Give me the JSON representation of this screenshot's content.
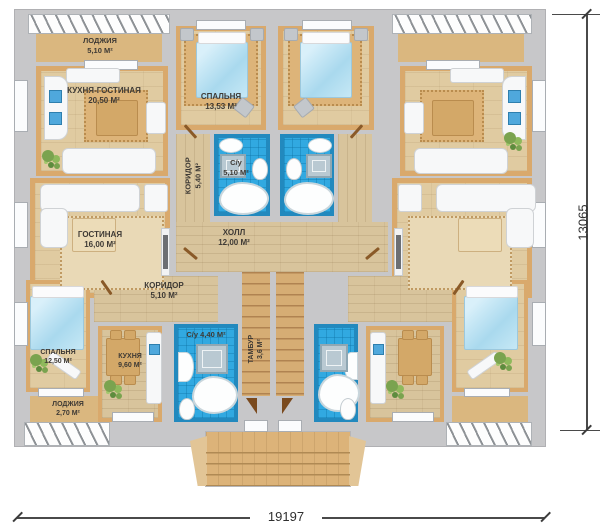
{
  "rooms": {
    "loggia_top_left": {
      "name": "ЛОДЖИЯ",
      "area": "5,10 М²"
    },
    "kitchen_living": {
      "name": "КУХНЯ-ГОСТИНАЯ",
      "area": "20,50 М²"
    },
    "bedroom_top": {
      "name": "СПАЛЬНЯ",
      "area": "13,53 М²"
    },
    "corridor_upper": {
      "name": "КОРИДОР",
      "area": "5,40 М²"
    },
    "bathroom_upper": {
      "name": "С/у",
      "area": "5,10 М²"
    },
    "living_room": {
      "name": "ГОСТИНАЯ",
      "area": "16,00 М²"
    },
    "hall": {
      "name": "ХОЛЛ",
      "area": "12,00 М²"
    },
    "corridor_lower": {
      "name": "КОРИДОР",
      "area": "5,10 М²"
    },
    "bedroom_lower": {
      "name": "СПАЛЬНЯ",
      "area": "12,50 М²"
    },
    "kitchen_lower": {
      "name": "КУХНЯ",
      "area": "9,60 М²"
    },
    "bathroom_lower": {
      "name": "С/у",
      "area": "4,40 М²"
    },
    "tambour": {
      "name": "ТАМБУР",
      "area": "3,6 М²"
    },
    "loggia_bottom_left": {
      "name": "ЛОДЖИЯ",
      "area": "2,70 М²"
    }
  },
  "dimensions": {
    "width": "19197",
    "height": "13065"
  },
  "colors": {
    "wall": "#c7c7c9",
    "floor_wood": "#e0cba1",
    "floor_accent": "#d9a96c",
    "bathroom_tile": "#31a9e1",
    "loggia_floor": "#dab77f",
    "dimension_line": "#4a4a4a"
  }
}
